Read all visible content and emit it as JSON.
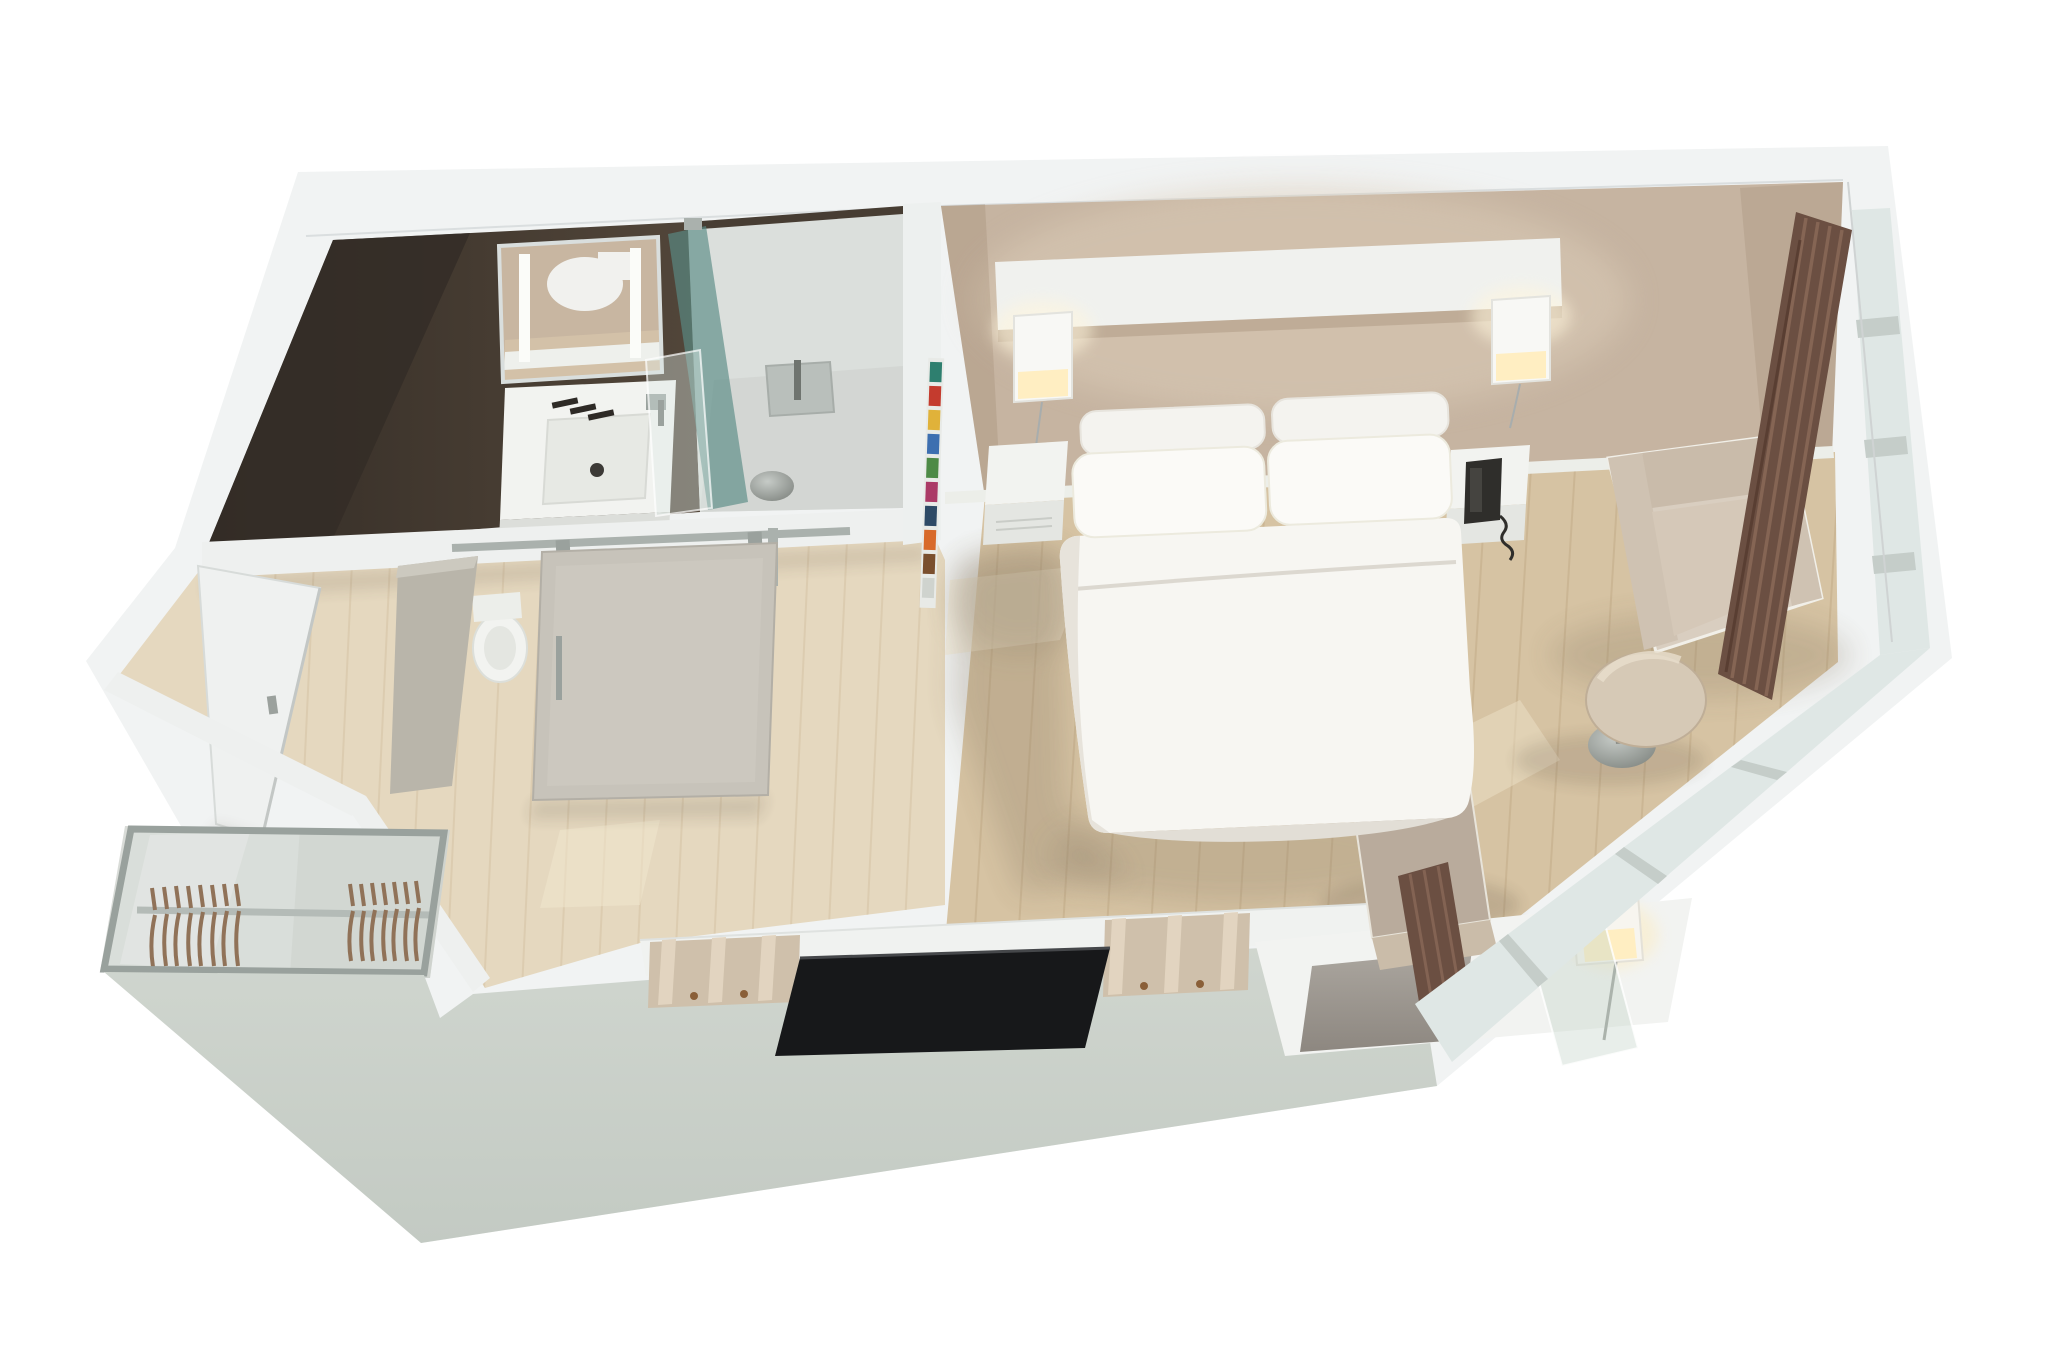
{
  "scene": {
    "description": "3D cutaway (dollhouse) floor plan render of a hotel studio guest room seen from above",
    "style": "isometric-cutaway-render",
    "background": "#ffffff",
    "rooms": [
      {
        "name": "bathroom",
        "wall_finish": "dark-espresso",
        "items": [
          "mirror",
          "vanity-sink",
          "faucet",
          "towel-hooks",
          "toilet",
          "walk-in-shower",
          "teal-glass-panel",
          "clear-glass-panel",
          "rain-shower-head",
          "floor-drain",
          "sliding-frosted-door",
          "door-rail"
        ]
      },
      {
        "name": "entry-hall",
        "items": [
          "entry-door",
          "door-handle",
          "partition-wall",
          "wood-floor"
        ]
      },
      {
        "name": "closet",
        "items": [
          "mirrored-frame",
          "hanging-rail",
          "wood-hangers-left-group",
          "wood-hangers-right-group"
        ]
      },
      {
        "name": "bedroom",
        "wall_finish": "warm-beige",
        "items": [
          "double-bed",
          "four-pillows",
          "duvet",
          "headboard-shelf",
          "cube-wall-lamp-left",
          "cube-wall-lamp-right",
          "floating-nightstand-left",
          "floating-nightstand-right",
          "telephone",
          "magazine-rack",
          "armchair",
          "round-side-table",
          "tv",
          "tv-console-shelf",
          "console-compartments",
          "desk",
          "desk-pad",
          "desk-cube-lamp",
          "leaning-glass-panel",
          "desk-chair",
          "curtains",
          "window-wall",
          "wood-floor"
        ]
      }
    ]
  },
  "palette": {
    "bg": "#ffffff",
    "slab": "#f1f3f3",
    "band": "#eef0ef",
    "sage": "#cbd1ca",
    "sage_deep": "#c0c7c0",
    "dark_wall": "#473d33",
    "dark_wall_deep": "#342d27",
    "beige_wall": "#c6b4a1",
    "beige_wall_light": "#dbccb8",
    "wood_bedroom": "#d6c3a3",
    "wood_hall": "#e5d8bf",
    "plank_seam": "#c3ac89",
    "shower_wall": "#dbdfdc",
    "shower_floor": "#d1d5d1",
    "teal_glass": "#5a8c85",
    "frosted_door": "#c7c3ba",
    "mirror_reflection": "#c8b6a1",
    "vanity_white": "#f2f3f0",
    "duvet": "#f7f6f2",
    "pillow": "#fbfaf7",
    "headboard": "#f0f1ee",
    "nightstand": "#f2f3f0",
    "lamp_glow": "#ffeec2",
    "phone": "#2f2e2b",
    "tv": "#17181a",
    "console_wood": "#d8c8b2",
    "curtain": "#6b4f42",
    "curtain_light": "#8a6857",
    "window_glass": "#dfe7e5",
    "mullion": "#c5cdc9",
    "armchair": "#d9cec0",
    "armchair_shade": "#c9bbaa",
    "side_table": "#d6c9b6",
    "metal": "#9aa29e",
    "hanger_wood": "#774c2b",
    "desk_pad": "#a39e97",
    "partition": "#b9b5aa",
    "door_white": "#eff1f0"
  }
}
